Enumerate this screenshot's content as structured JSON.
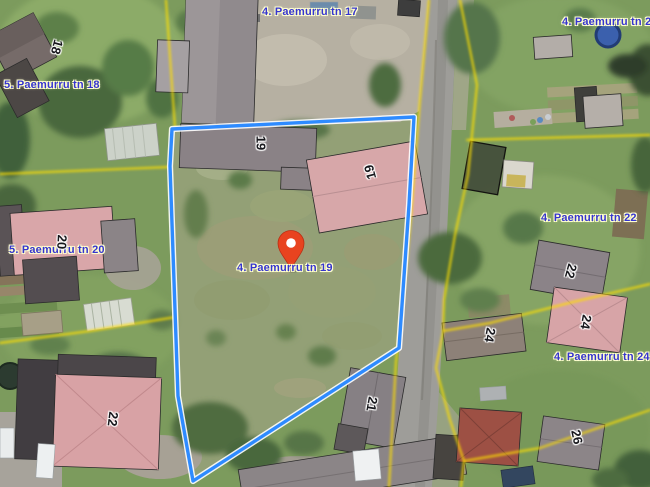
{
  "app": {
    "view": "aerial-cadastral-map"
  },
  "map": {
    "selected_address": "4. Paemurru tn 19",
    "address_labels": [
      {
        "text": "5. Paemurru tn 18"
      },
      {
        "text": "4. Paemurru tn 17"
      },
      {
        "text": "4. Paemurru tn 20"
      },
      {
        "text": "5. Paemurru tn 20"
      },
      {
        "text": "4. Paemurru tn 19"
      },
      {
        "text": "4. Paemurru tn 22"
      },
      {
        "text": "4. Paemurru tn 24"
      }
    ],
    "building_numbers": [
      "18",
      "19",
      "19",
      "20",
      "21",
      "22",
      "22",
      "24",
      "24",
      "26"
    ],
    "marker": {
      "address": "4. Paemurru tn 19"
    },
    "colors": {
      "marker": "#e8431f",
      "parcel_outline": "#2e8bff",
      "parcel_outline_halo": "#ffffff",
      "cadastral_line": "#ffdf00",
      "label_text": "#3534cf",
      "label_halo": "#ffffd0"
    }
  }
}
